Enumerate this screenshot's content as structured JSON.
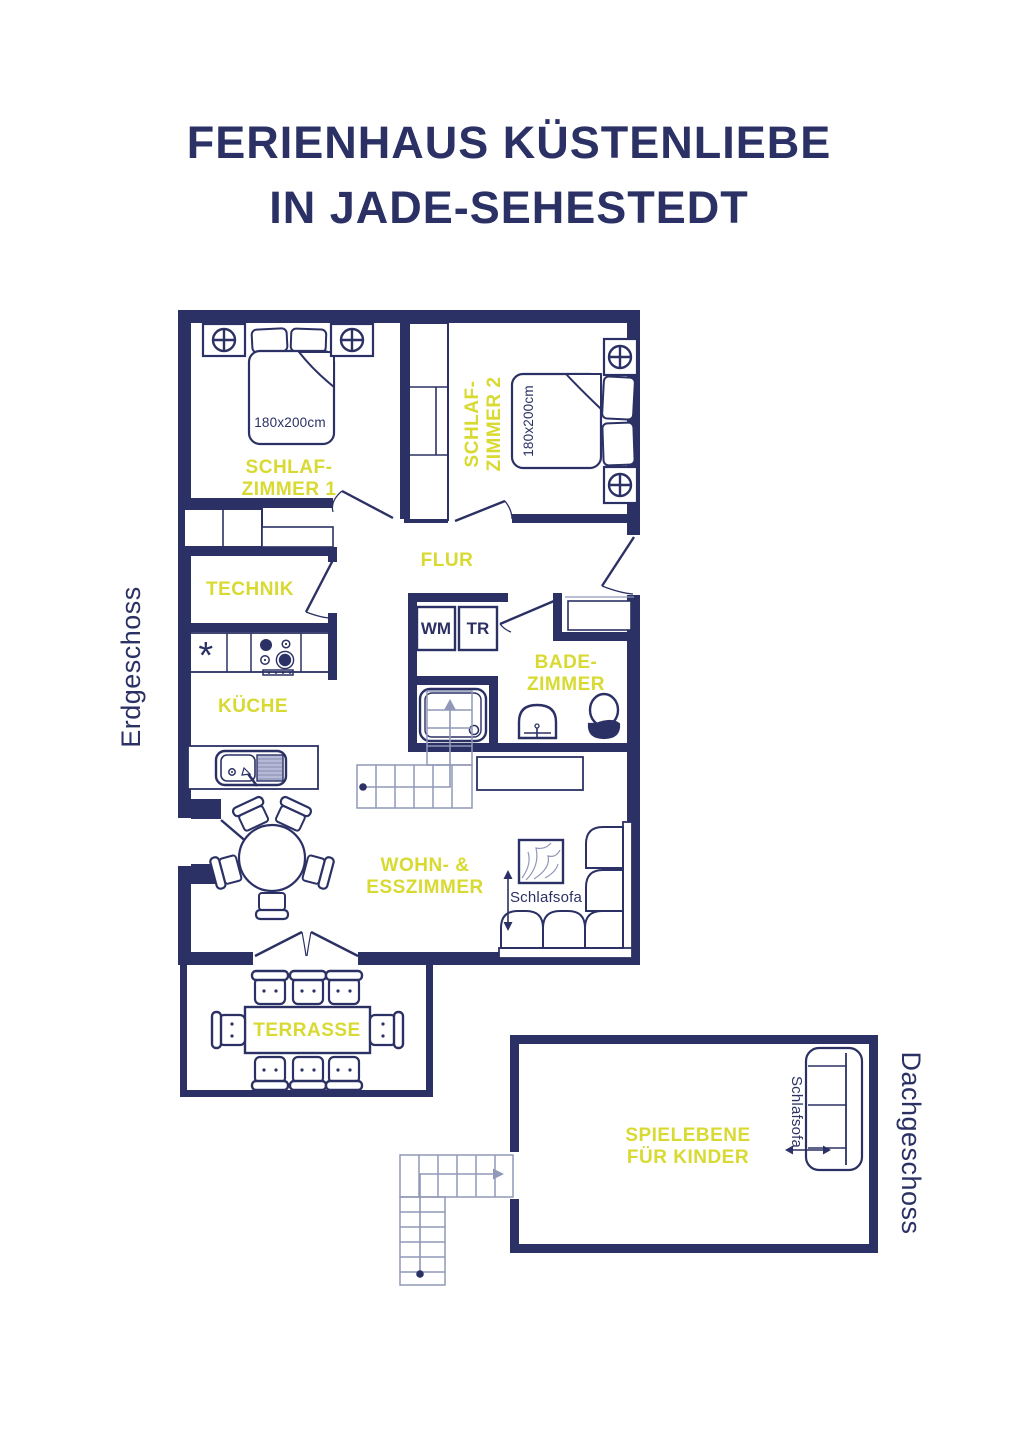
{
  "title": {
    "line1": "FERIENHAUS KÜSTENLIEBE",
    "line2": "IN JADE-SEHESTEDT"
  },
  "floor_labels": {
    "ground": "Erdgeschoss",
    "attic": "Dachgeschoss"
  },
  "rooms": {
    "bedroom1": {
      "name_line1": "SCHLAF-",
      "name_line2": "ZIMMER 1",
      "bed_size": "180x200cm"
    },
    "bedroom2": {
      "name_line1": "SCHLAF-",
      "name_line2": "ZIMMER 2",
      "bed_size": "180x200cm"
    },
    "hallway": {
      "name": "FLUR"
    },
    "utility": {
      "name": "TECHNIK"
    },
    "kitchen": {
      "name": "KÜCHE",
      "fridge_symbol": "*"
    },
    "bathroom": {
      "name_line1": "BADE-",
      "name_line2": "ZIMMER",
      "washer": "WM",
      "dryer": "TR"
    },
    "living_dining": {
      "name_line1": "WOHN- &",
      "name_line2": "ESSZIMMER",
      "sofa_label": "Schlafsofa"
    },
    "terrace": {
      "name": "TERRASSE"
    },
    "play_area": {
      "name_line1": "SPIELEBENE",
      "name_line2": "FÜR KINDER",
      "sofa_label": "Schlafsofa"
    }
  },
  "colors": {
    "wall": "#2b3164",
    "accent_label": "#d8da31",
    "stairs": "#9198b8",
    "background": "#ffffff"
  }
}
